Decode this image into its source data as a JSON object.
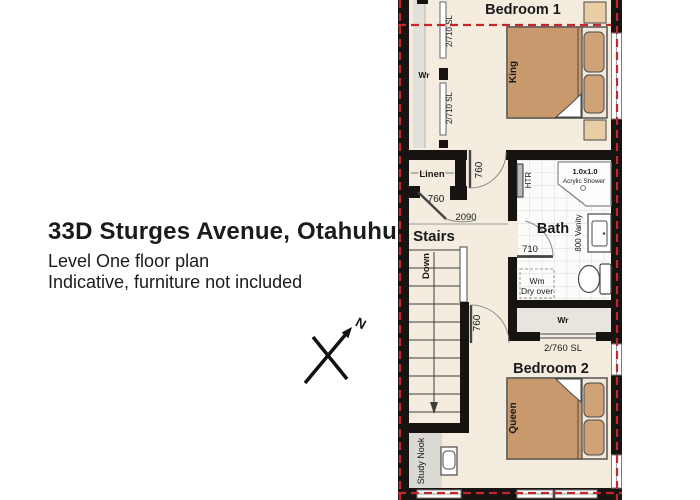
{
  "header": {
    "title": "33D Sturges Avenue, Otahuhu",
    "subtitle": "Level One floor plan",
    "note": "Indicative, furniture not included"
  },
  "compass": {
    "north": "N"
  },
  "colors": {
    "wall": "#171310",
    "boundary_red": "#c1272d",
    "floor": "#f3ecdf",
    "closet_floor": "#e2e0d9",
    "bed": "#c8996d",
    "pillow": "#cfa377",
    "nightstand": "#e9cda4",
    "tile_line": "#d8d8d8"
  },
  "plan": {
    "bedroom1": {
      "name": "Bedroom 1",
      "bed_size": "King",
      "wardrobe": "Wr",
      "slider_top": "2/710 SL",
      "slider_bottom": "2/710 SL"
    },
    "linen": {
      "name": "Linen",
      "door_width": "760"
    },
    "hall": {
      "bedroom1_door": "760",
      "width_dim": "2090"
    },
    "stairs": {
      "name": "Stairs",
      "direction": "Down"
    },
    "bath": {
      "name": "Bath",
      "towel_rail": "HTR",
      "shower_size": "1.0x1.0",
      "shower_label": "Acrylic Shower",
      "vanity": "800 Vanity",
      "door_width": "710",
      "washer": "Wm",
      "washer_note": "Dry over"
    },
    "wardrobe2": {
      "name": "Wr",
      "slider": "2/760 SL"
    },
    "bedroom2": {
      "name": "Bedroom 2",
      "bed_size": "Queen",
      "door_width": "760"
    },
    "study": {
      "name": "Study Nook"
    }
  }
}
